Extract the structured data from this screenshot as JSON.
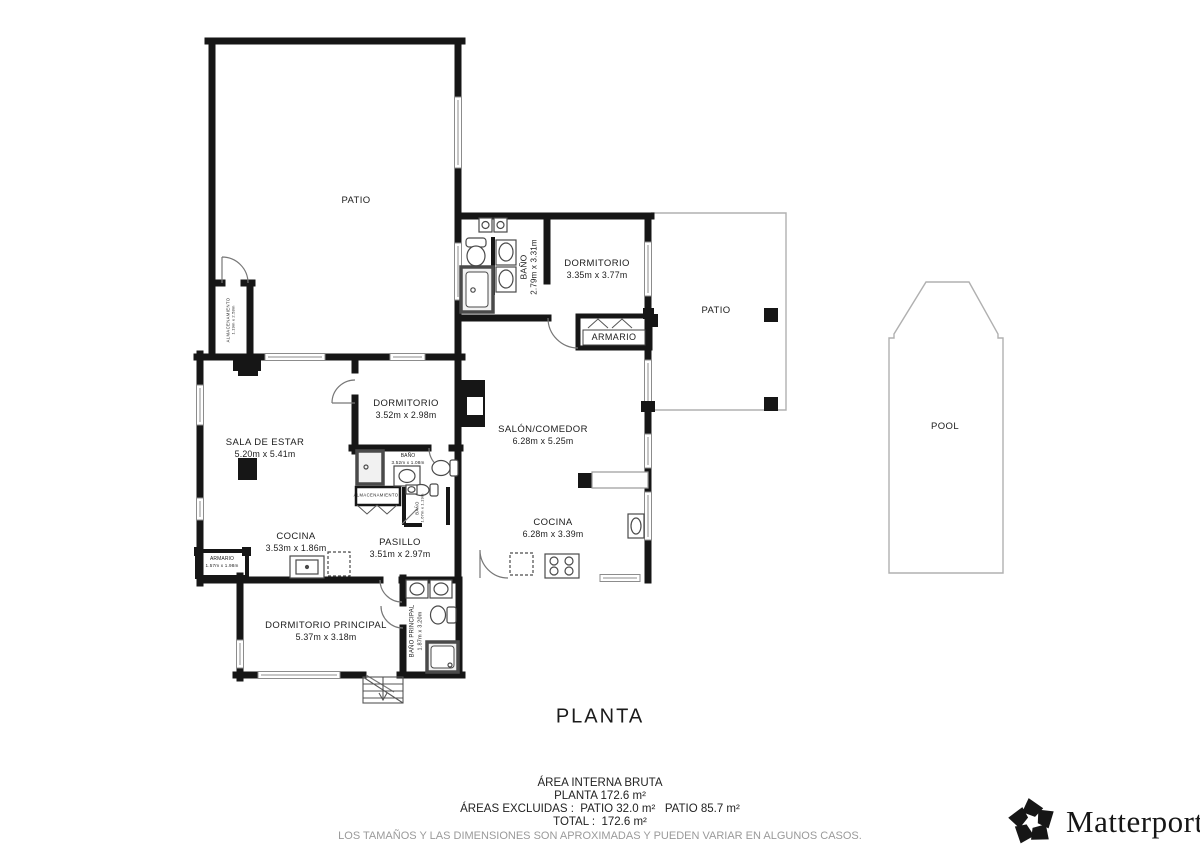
{
  "title": "PLANTA",
  "rooms": {
    "patio_top": {
      "name": "PATIO"
    },
    "bano_top": {
      "name": "BAÑO",
      "dims": "2.79m x 3.31m"
    },
    "dormitorio_top": {
      "name": "DORMITORIO",
      "dims": "3.35m x 3.77m"
    },
    "patio_right": {
      "name": "PATIO"
    },
    "armario_top": {
      "name": "ARMARIO"
    },
    "almacenamiento_left": {
      "name": "ALMACENAMIENTO",
      "dims": "1.19m x 2.58m"
    },
    "sala_de_estar": {
      "name": "SALA DE ESTAR",
      "dims": "5.20m x 5.41m"
    },
    "dormitorio_mid": {
      "name": "DORMITORIO",
      "dims": "3.52m x 2.98m"
    },
    "salon_comedor": {
      "name": "SALÓN/COMEDOR",
      "dims": "6.28m x 5.25m"
    },
    "bano_mid": {
      "name": "BAÑO",
      "dims": "3.52m x 1.08m"
    },
    "almacenamiento_mid": {
      "name": "ALMACENAMIENTO"
    },
    "bano_small": {
      "name": "BAÑO",
      "dims": "1.67m x 1.19m"
    },
    "cocina_left": {
      "name": "COCINA",
      "dims": "3.53m x 1.86m"
    },
    "pasillo": {
      "name": "PASILLO",
      "dims": "3.51m x 2.97m"
    },
    "armario_left": {
      "name": "ARMARIO",
      "dims": "1.57m x 1.98m"
    },
    "cocina_right": {
      "name": "COCINA",
      "dims": "6.28m x 3.39m"
    },
    "dormitorio_principal": {
      "name": "DORMITORIO PRINCIPAL",
      "dims": "5.37m x 3.18m"
    },
    "bano_principal": {
      "name": "BAÑO PRINCIPAL",
      "dims": "1.87m x 3.20m"
    },
    "pool": {
      "name": "POOL"
    }
  },
  "footer": {
    "line1": "ÁREA INTERNA BRUTA",
    "line2": "PLANTA 172.6 m²",
    "line3": "ÁREAS EXCLUIDAS :  PATIO 32.0 m²   PATIO 85.7 m²",
    "line4": "TOTAL :  172.6 m²",
    "disclaimer": "LOS TAMAÑOS Y LAS DIMENSIONES SON APROXIMADAS Y PUEDEN VARIAR EN ALGUNOS CASOS."
  },
  "brand": {
    "name": "Matterport",
    "mark": "®"
  },
  "colors": {
    "wall": "#161616",
    "thin_outline": "#b0b0b0",
    "fixture": "#4a4a4a",
    "gray_text": "#9a9a9a"
  }
}
